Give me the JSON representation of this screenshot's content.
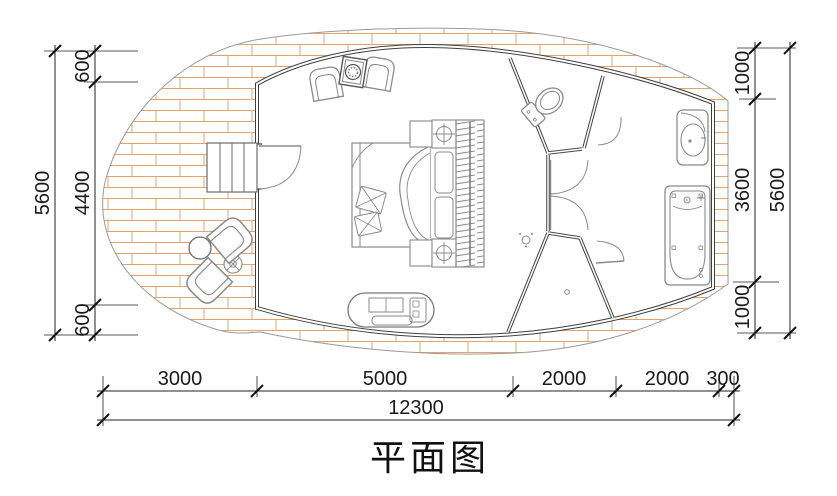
{
  "title": {
    "text": "平面图"
  },
  "colors": {
    "brick_line": "#e0a470",
    "wall": "#3f3f3f",
    "partition": "#4a4a4a",
    "furniture_line": "#8a8a8a",
    "deck_edge": "#9a9a9a",
    "dim_line": "#222222",
    "dim_text": "#1a1a1a"
  },
  "dims": {
    "left": {
      "segments": [
        {
          "label": "600"
        },
        {
          "label": "4400"
        },
        {
          "label": "600"
        }
      ],
      "total": {
        "label": "5600"
      }
    },
    "right": {
      "segments": [
        {
          "label": "1000"
        },
        {
          "label": "3600"
        },
        {
          "label": "1000"
        }
      ],
      "total": {
        "label": "5600"
      }
    },
    "bottom": {
      "segments": [
        {
          "label": "3000"
        },
        {
          "label": "5000"
        },
        {
          "label": "2000"
        },
        {
          "label": "2000"
        },
        {
          "label": "300"
        }
      ],
      "total": {
        "label": "12300"
      }
    }
  },
  "features": [
    "wood-deck",
    "entry-stairs",
    "entry-door",
    "deck-table",
    "deck-chairs",
    "flower-pot",
    "armchairs",
    "side-table",
    "double-bed",
    "pillows",
    "duvet",
    "nightstand-lamps",
    "wardrobe",
    "tv-bench",
    "wc-room",
    "toilet",
    "corridor-doors",
    "shower-room",
    "shower-head",
    "floor-drain",
    "washbasin",
    "bathtub"
  ]
}
